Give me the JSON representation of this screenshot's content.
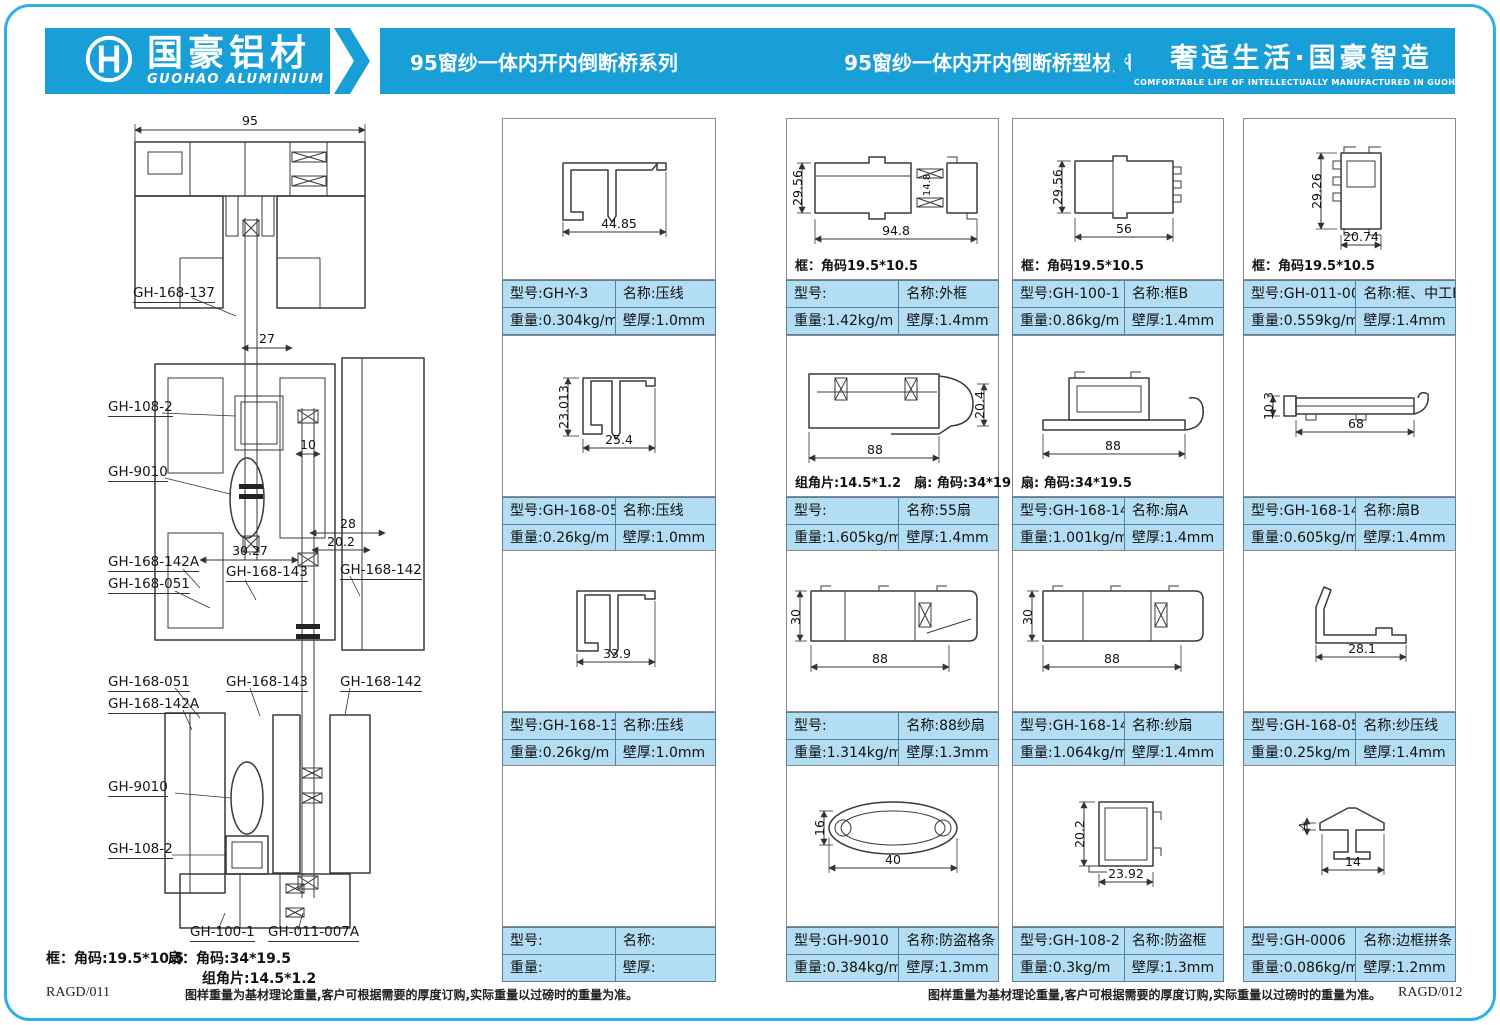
{
  "header": {
    "logo_cn": "国豪铝材",
    "logo_en": "GUOHAO ALUMINIUM",
    "series_title": "95窗纱一体内开内倒断桥系列",
    "diagram_title": "95窗纱一体内开内倒断桥型材图",
    "slogan_cn": "奢适生活·国豪智造",
    "slogan_en": "COMFORTABLE LIFE OF INTELLECTUALLY MANUFACTURED IN GUOHAO",
    "brand_blue": "#189fd8"
  },
  "labels": {
    "model": "型号:",
    "name": "名称:",
    "weight": "重量:",
    "thickness": "壁厚:"
  },
  "assembly": {
    "dims": {
      "d95": "95",
      "d27": "27",
      "d10": "10",
      "d28": "28",
      "d202": "20.2",
      "d3027": "30.27"
    },
    "parts": [
      "GH-168-137",
      "GH-108-2",
      "GH-9010",
      "GH-168-142A",
      "GH-168-051",
      "GH-168-143",
      "GH-168-142",
      "GH-168-051",
      "GH-168-142A",
      "GH-168-143",
      "GH-168-142",
      "GH-9010",
      "GH-108-2",
      "GH-100-1",
      "GH-011-007A"
    ],
    "corner_note_frame": "框：角码:19.5*10.5",
    "corner_note_sash": "扇：角码:34*19.5",
    "corner_note_piece": "组角片:14.5*1.2"
  },
  "footer": {
    "note": "图样重量为基材理论重量,客户可根据需要的厚度订购,实际重量以过磅时的重量为准。",
    "page_left": "RAGD/011",
    "page_right": "RAGD/012"
  },
  "cards": [
    {
      "model": "GH-Y-3",
      "name": "压线",
      "weight": "0.304kg/m",
      "thickness": "1.0mm",
      "note": "",
      "dims": [
        "44.85"
      ]
    },
    {
      "model": "",
      "name": "外框",
      "weight": "1.42kg/m",
      "thickness": "1.4mm",
      "note": "框：角码19.5*10.5",
      "dims": [
        "29.56",
        "94.8",
        "14.8"
      ]
    },
    {
      "model": "GH-100-1",
      "name": "框B",
      "weight": "0.86kg/m",
      "thickness": "1.4mm",
      "note": "框：角码19.5*10.5",
      "dims": [
        "29.56",
        "56"
      ]
    },
    {
      "model": "GH-011-007A",
      "name": "框、中工B",
      "weight": "0.559kg/m",
      "thickness": "1.4mm",
      "note": "框：角码19.5*10.5",
      "dims": [
        "29.26",
        "20.74"
      ]
    },
    {
      "model": "GH-168-055",
      "name": "压线",
      "weight": "0.26kg/m",
      "thickness": "1.0mm",
      "note": "",
      "dims": [
        "23.013",
        "25.4"
      ]
    },
    {
      "model": "",
      "name": "55扇",
      "weight": "1.605kg/m",
      "thickness": "1.4mm",
      "note": "组角片:14.5*1.2　扇: 角码:34*19.5",
      "dims": [
        "20.4",
        "88"
      ]
    },
    {
      "model": "GH-168-142",
      "name": "扇A",
      "weight": "1.001kg/m",
      "thickness": "1.4mm",
      "note": "扇: 角码:34*19.5",
      "dims": [
        "88"
      ]
    },
    {
      "model": "GH-168-143",
      "name": "扇B",
      "weight": "0.605kg/m",
      "thickness": "1.4mm",
      "note": "",
      "dims": [
        "10.3",
        "68"
      ]
    },
    {
      "model": "GH-168-137",
      "name": "压线",
      "weight": "0.26kg/m",
      "thickness": "1.0mm",
      "note": "",
      "dims": [
        "33.9"
      ]
    },
    {
      "model": "",
      "name": "88纱扇",
      "weight": "1.314kg/m",
      "thickness": "1.3mm",
      "note": "",
      "dims": [
        "30",
        "88"
      ]
    },
    {
      "model": "GH-168-142A",
      "name": "纱扇",
      "weight": "1.064kg/m",
      "thickness": "1.4mm",
      "note": "",
      "dims": [
        "30",
        "88"
      ]
    },
    {
      "model": "GH-168-051",
      "name": "纱压线",
      "weight": "0.25kg/m",
      "thickness": "1.4mm",
      "note": "",
      "dims": [
        "28.1"
      ]
    },
    {
      "model": "",
      "name": "",
      "weight": "",
      "thickness": "",
      "note": "",
      "dims": []
    },
    {
      "model": "GH-9010",
      "name": "防盗格条",
      "weight": "0.384kg/m",
      "thickness": "1.3mm",
      "note": "",
      "dims": [
        "16",
        "40"
      ]
    },
    {
      "model": "GH-108-2",
      "name": "防盗框",
      "weight": "0.3kg/m",
      "thickness": "1.3mm",
      "note": "",
      "dims": [
        "20.2",
        "23.92"
      ]
    },
    {
      "model": "GH-0006",
      "name": "边框拼条",
      "weight": "0.086kg/m",
      "thickness": "1.2mm",
      "note": "",
      "dims": [
        "4",
        "14"
      ]
    }
  ]
}
